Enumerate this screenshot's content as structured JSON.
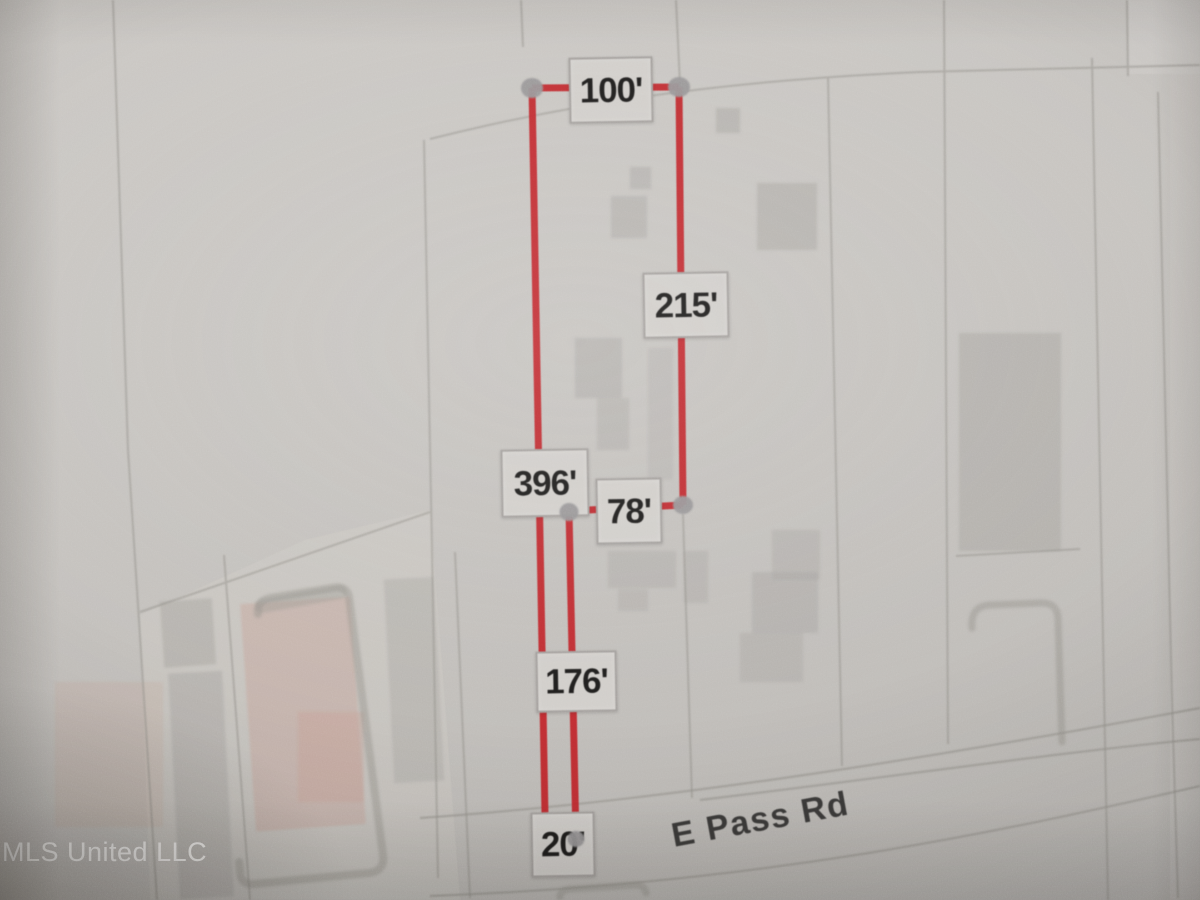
{
  "photo": {
    "watermark": "MLS United LLC"
  },
  "map": {
    "road": {
      "name": "E Pass Rd"
    },
    "parcel_measurements": [
      {
        "side": "north",
        "label": "100'"
      },
      {
        "side": "east-upper",
        "label": "215'"
      },
      {
        "side": "west",
        "label": "396'"
      },
      {
        "side": "jog",
        "label": "78'"
      },
      {
        "side": "east-lower",
        "label": "176'"
      },
      {
        "side": "road-frontage",
        "label": "20'"
      }
    ],
    "colors": {
      "measure_red": "#c5242b",
      "vertex_gray": "#9a999b",
      "label_bg": "#d6d4d1",
      "label_text": "#1a1a1a",
      "road_text": "#383838",
      "map_line": "#96948f",
      "building_fill": "#a9a7a4",
      "tint_pink": "#c99f92",
      "watermark_color": "#ffffff"
    }
  }
}
